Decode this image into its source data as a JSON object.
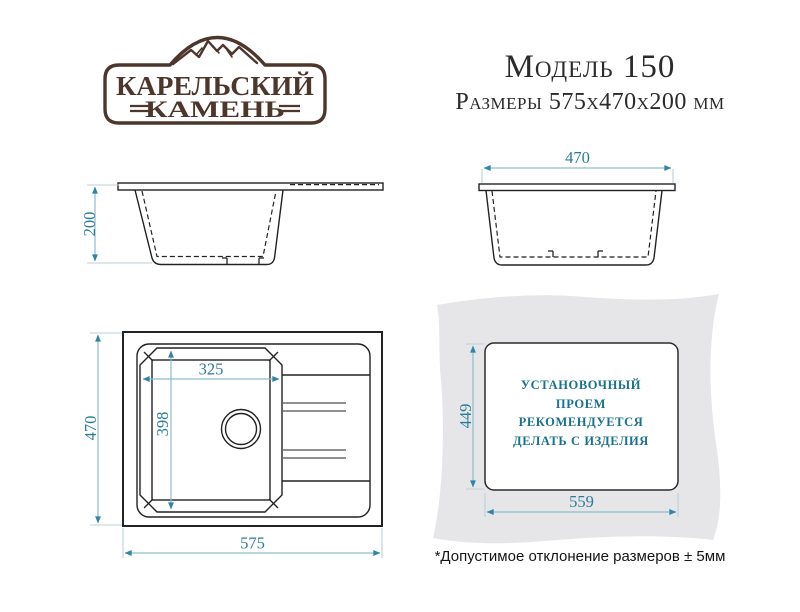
{
  "brand": {
    "name_line1": "КАРЕЛЬСКИЙ",
    "name_line2": "КАМЕНЬ"
  },
  "header": {
    "model_title": "Модель 150",
    "dimensions_subtitle": "Размеры 575х470х200 мм"
  },
  "dims": {
    "side_height": "200",
    "front_width": "470",
    "bowl_width": "325",
    "bowl_depth": "398",
    "overall_depth": "470",
    "overall_width": "575",
    "cutout_height": "449",
    "cutout_width": "559"
  },
  "installation": {
    "note_lines": [
      "УСТАНОВОЧНЫЙ",
      "ПРОЕМ",
      "РЕКОМЕНДУЕТСЯ",
      "ДЕЛАТЬ С ИЗДЕЛИЯ"
    ]
  },
  "footnote": "*Допустимое отклонение размеров ± 5мм",
  "colors": {
    "dimension_accent": "#2f85a4",
    "drawing_line": "#222222",
    "brand_brown": "#4d362b",
    "panel_gray": "#e6e6e8",
    "install_text": "#17718f"
  }
}
